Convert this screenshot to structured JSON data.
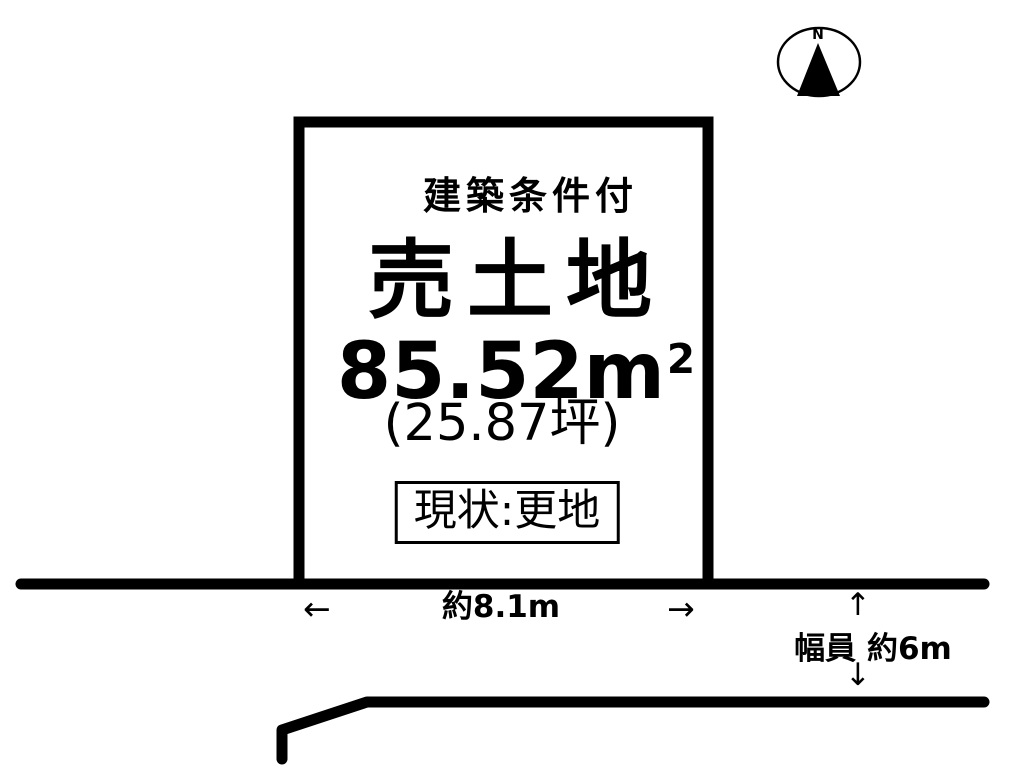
{
  "compass": {
    "north_label": "N"
  },
  "plot": {
    "condition_label": "建築条件付",
    "title": "売土地",
    "area_sqm": "85.52m",
    "area_sqm_sup": "2",
    "area_tsubo": "(25.87坪)",
    "status_label": "現状:更地"
  },
  "frontage": {
    "left_arrow": "←",
    "label": "約8.1m",
    "right_arrow": "→"
  },
  "road_width": {
    "up_arrow": "↑",
    "label": "幅員 約6m",
    "down_arrow": "↓"
  },
  "colors": {
    "line": "#000000",
    "background": "#ffffff"
  }
}
